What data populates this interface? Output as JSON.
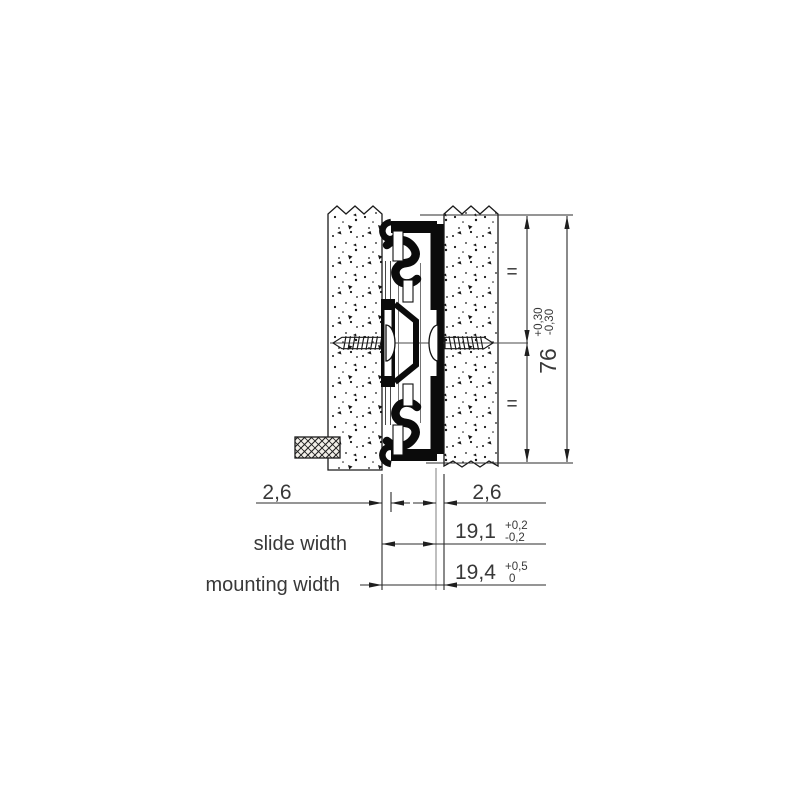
{
  "drawing_type": "drawer-slide-cross-section",
  "colors": {
    "background": "#ffffff",
    "line": "#2b2b2b",
    "gray_line": "#8a8a8a",
    "text": "#383838",
    "profile": "#0b0b0b"
  },
  "dimensions": {
    "left_clearance": {
      "value": "2,6"
    },
    "right_clearance": {
      "value": "2,6"
    },
    "slide_width": {
      "label": "slide width",
      "value": "19,1",
      "tol_upper": "+0,2",
      "tol_lower": "-0,2"
    },
    "mounting_width": {
      "label": "mounting width",
      "value": "19,4",
      "tol_upper": "+0,5",
      "tol_lower": "0"
    },
    "height": {
      "value": "76",
      "tol_upper": "+0,30",
      "tol_lower": "-0,30"
    }
  },
  "symbols": {
    "equal_spacing": "="
  }
}
